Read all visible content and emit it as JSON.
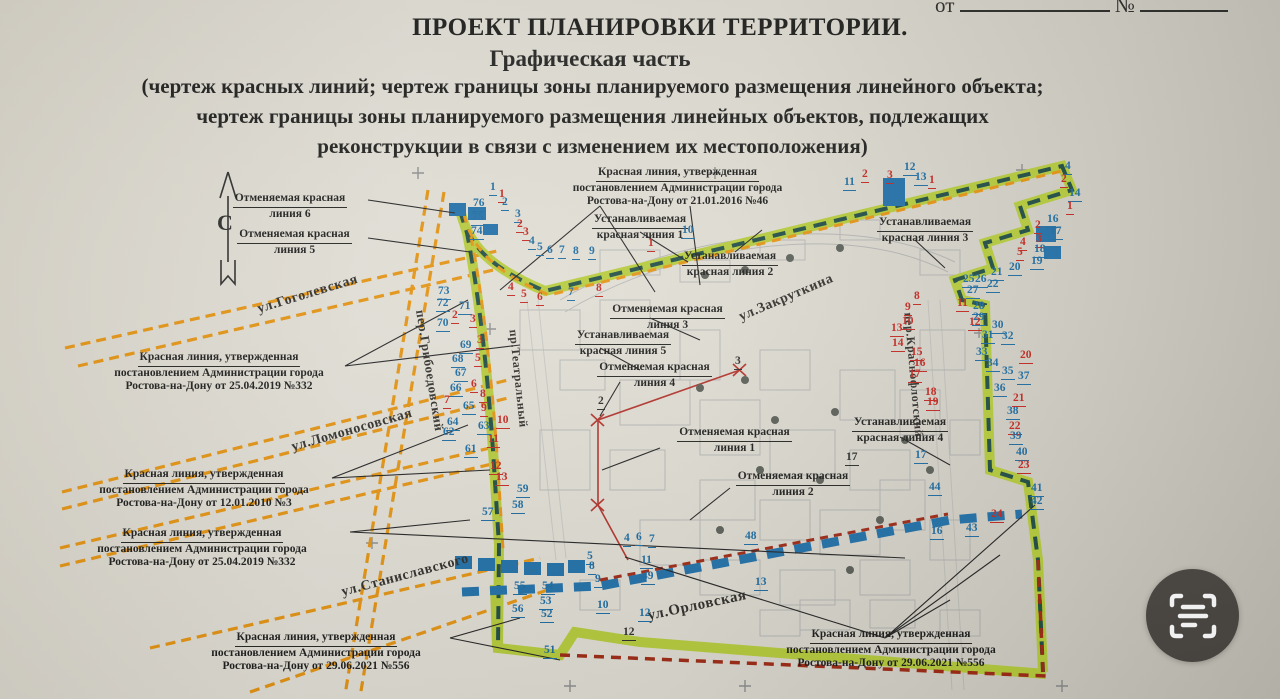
{
  "header": {
    "doc_line_prefix": "от",
    "doc_line_number_sign": "№",
    "title": "ПРОЕКТ ПЛАНИРОВКИ ТЕРРИТОРИИ.",
    "subtitle": "Графическая часть",
    "description_lines": [
      "(чертеж красных линий; чертеж границы зоны планируемого размещения линейного объекта;",
      "чертеж границы зоны планируемого размещения линейных объектов, подлежащих",
      "реконструкции в связи с изменением их местоположения)"
    ]
  },
  "compass": {
    "north_label": "С"
  },
  "colors": {
    "paper": "#ddd9cf",
    "ink": "#1d1d1b",
    "ref_blue": "#19699f",
    "ref_red": "#c1241c",
    "boundary_green": "#b4ca39",
    "boundary_teal": "#1c4a41",
    "street_orange": "#e3920f",
    "line_blue": "#1e6ea7",
    "line_dark_red": "#9c2712",
    "button_bg": "#48443f"
  },
  "callouts": [
    {
      "x": 205,
      "y": 192,
      "w": 170,
      "lines": [
        "Отменяемая красная",
        "линия 6"
      ]
    },
    {
      "x": 212,
      "y": 228,
      "w": 165,
      "lines": [
        "Отменяемая красная",
        "линия 5"
      ]
    },
    {
      "x": 545,
      "y": 166,
      "w": 265,
      "lines": [
        "Красная линия, утвержденная",
        "постановлением Администрации города",
        "Ростова-на-Дону от 21.01.2016 №46"
      ]
    },
    {
      "x": 565,
      "y": 213,
      "w": 150,
      "lines": [
        "Устанавливаемая",
        "красная линия 1"
      ]
    },
    {
      "x": 660,
      "y": 250,
      "w": 140,
      "lines": [
        "Устанавливаемая",
        "красная линия 2"
      ]
    },
    {
      "x": 855,
      "y": 216,
      "w": 140,
      "lines": [
        "Устанавливаемая",
        "красная линия 3"
      ]
    },
    {
      "x": 585,
      "y": 303,
      "w": 165,
      "lines": [
        "Отменяемая красная",
        "линия 3"
      ]
    },
    {
      "x": 548,
      "y": 329,
      "w": 150,
      "lines": [
        "Устанавливаемая",
        "красная линия 5"
      ]
    },
    {
      "x": 572,
      "y": 361,
      "w": 165,
      "lines": [
        "Отменяемая красная",
        "линия 4"
      ]
    },
    {
      "x": 652,
      "y": 426,
      "w": 165,
      "lines": [
        "Отменяемая красная",
        "линия 1"
      ]
    },
    {
      "x": 826,
      "y": 416,
      "w": 148,
      "lines": [
        "Устанавливаемая",
        "красная линия 4"
      ]
    },
    {
      "x": 712,
      "y": 470,
      "w": 162,
      "lines": [
        "Отменяемая красная",
        "линия 2"
      ]
    },
    {
      "x": 90,
      "y": 351,
      "w": 258,
      "lines": [
        "Красная линия, утвержденная",
        "постановлением Администрации города",
        "Ростова-на-Дону от 25.04.2019 №332"
      ]
    },
    {
      "x": 75,
      "y": 468,
      "w": 258,
      "lines": [
        "Красная линия, утвержденная",
        "постановлением Администрации города",
        "Ростова-на-Дону от 12.01.2010 №3"
      ]
    },
    {
      "x": 73,
      "y": 527,
      "w": 258,
      "lines": [
        "Красная линия, утвержденная",
        "постановлением Администрации города",
        "Ростова-на-Дону от 25.04.2019 №332"
      ]
    },
    {
      "x": 182,
      "y": 631,
      "w": 268,
      "lines": [
        "Красная линия, утвержденная",
        "постановлением Администрации города",
        "Ростова-на-Дону от 29.06.2021 №556"
      ]
    },
    {
      "x": 762,
      "y": 628,
      "w": 258,
      "lines": [
        "Красная линия, утвержденная",
        "постановлением Администрации города",
        "Ростова-на-Дону от 29.06.2021 №556"
      ]
    }
  ],
  "streets": [
    {
      "name": "ул.Гоголевская",
      "x": 258,
      "y": 302,
      "r": -17,
      "fs": 14
    },
    {
      "name": "пер.Грибоедовский",
      "x": 420,
      "y": 302,
      "r": 81,
      "fs": 13
    },
    {
      "name": "ул.Ломоносовская",
      "x": 292,
      "y": 440,
      "r": -16,
      "fs": 14
    },
    {
      "name": "ул.Станиславского",
      "x": 342,
      "y": 585,
      "r": -15,
      "fs": 14
    },
    {
      "name": "ул.Закруткина",
      "x": 740,
      "y": 310,
      "r": -23,
      "fs": 14
    },
    {
      "name": "ул.Орловская",
      "x": 648,
      "y": 608,
      "r": -12,
      "fs": 15
    },
    {
      "name": "пр.Театральный",
      "x": 513,
      "y": 322,
      "r": 84,
      "fs": 12
    },
    {
      "name": "пер.Краснофлотский",
      "x": 908,
      "y": 305,
      "r": 85,
      "fs": 12
    }
  ],
  "markers": [
    {
      "n": "76",
      "x": 472,
      "y": 198,
      "c": "b"
    },
    {
      "n": "75",
      "x": 471,
      "y": 212,
      "c": "b"
    },
    {
      "n": "74",
      "x": 470,
      "y": 226,
      "c": "b"
    },
    {
      "n": "73",
      "x": 437,
      "y": 286,
      "c": "b"
    },
    {
      "n": "72",
      "x": 436,
      "y": 298,
      "c": "b"
    },
    {
      "n": "71",
      "x": 458,
      "y": 301,
      "c": "b"
    },
    {
      "n": "2",
      "x": 451,
      "y": 310,
      "c": "r"
    },
    {
      "n": "3",
      "x": 469,
      "y": 314,
      "c": "r"
    },
    {
      "n": "70",
      "x": 436,
      "y": 318,
      "c": "b"
    },
    {
      "n": "69",
      "x": 459,
      "y": 340,
      "c": "b"
    },
    {
      "n": "3",
      "x": 476,
      "y": 335,
      "c": "r"
    },
    {
      "n": "68",
      "x": 451,
      "y": 354,
      "c": "b"
    },
    {
      "n": "5",
      "x": 474,
      "y": 353,
      "c": "r"
    },
    {
      "n": "67",
      "x": 454,
      "y": 368,
      "c": "b"
    },
    {
      "n": "66",
      "x": 449,
      "y": 383,
      "c": "b"
    },
    {
      "n": "6",
      "x": 470,
      "y": 379,
      "c": "r"
    },
    {
      "n": "7",
      "x": 443,
      "y": 395,
      "c": "r"
    },
    {
      "n": "65",
      "x": 462,
      "y": 401,
      "c": "b"
    },
    {
      "n": "8",
      "x": 479,
      "y": 389,
      "c": "r"
    },
    {
      "n": "64",
      "x": 446,
      "y": 417,
      "c": "b"
    },
    {
      "n": "9",
      "x": 480,
      "y": 403,
      "c": "r"
    },
    {
      "n": "63",
      "x": 477,
      "y": 421,
      "c": "b"
    },
    {
      "n": "10",
      "x": 496,
      "y": 415,
      "c": "r"
    },
    {
      "n": "62",
      "x": 442,
      "y": 427,
      "c": "b"
    },
    {
      "n": "11",
      "x": 487,
      "y": 434,
      "c": "r"
    },
    {
      "n": "61",
      "x": 464,
      "y": 444,
      "c": "b"
    },
    {
      "n": "12",
      "x": 489,
      "y": 461,
      "c": "r"
    },
    {
      "n": "13",
      "x": 495,
      "y": 472,
      "c": "r"
    },
    {
      "n": "59",
      "x": 516,
      "y": 484,
      "c": "b"
    },
    {
      "n": "58",
      "x": 511,
      "y": 500,
      "c": "b"
    },
    {
      "n": "57",
      "x": 481,
      "y": 507,
      "c": "b"
    },
    {
      "n": "1",
      "x": 489,
      "y": 182,
      "c": "b"
    },
    {
      "n": "1",
      "x": 498,
      "y": 189,
      "c": "r"
    },
    {
      "n": "2",
      "x": 501,
      "y": 197,
      "c": "b"
    },
    {
      "n": "3",
      "x": 514,
      "y": 209,
      "c": "b"
    },
    {
      "n": "2",
      "x": 516,
      "y": 219,
      "c": "r"
    },
    {
      "n": "3",
      "x": 522,
      "y": 227,
      "c": "r"
    },
    {
      "n": "4",
      "x": 528,
      "y": 236,
      "c": "b"
    },
    {
      "n": "5",
      "x": 536,
      "y": 242,
      "c": "b"
    },
    {
      "n": "6",
      "x": 546,
      "y": 245,
      "c": "b"
    },
    {
      "n": "7",
      "x": 558,
      "y": 245,
      "c": "b"
    },
    {
      "n": "8",
      "x": 572,
      "y": 246,
      "c": "b"
    },
    {
      "n": "9",
      "x": 588,
      "y": 246,
      "c": "b"
    },
    {
      "n": "4",
      "x": 507,
      "y": 282,
      "c": "r"
    },
    {
      "n": "5",
      "x": 520,
      "y": 289,
      "c": "r"
    },
    {
      "n": "6",
      "x": 536,
      "y": 292,
      "c": "r"
    },
    {
      "n": "7",
      "x": 567,
      "y": 287,
      "c": "b"
    },
    {
      "n": "8",
      "x": 595,
      "y": 283,
      "c": "r"
    },
    {
      "n": "10",
      "x": 681,
      "y": 225,
      "c": "b"
    },
    {
      "n": "1",
      "x": 647,
      "y": 238,
      "c": "r"
    },
    {
      "n": "11",
      "x": 843,
      "y": 177,
      "c": "b"
    },
    {
      "n": "2",
      "x": 861,
      "y": 169,
      "c": "r"
    },
    {
      "n": "3",
      "x": 886,
      "y": 170,
      "c": "r"
    },
    {
      "n": "12",
      "x": 903,
      "y": 162,
      "c": "b"
    },
    {
      "n": "13",
      "x": 914,
      "y": 172,
      "c": "b"
    },
    {
      "n": "1",
      "x": 928,
      "y": 175,
      "c": "r"
    },
    {
      "n": "4",
      "x": 1064,
      "y": 161,
      "c": "b"
    },
    {
      "n": "2",
      "x": 1060,
      "y": 174,
      "c": "r"
    },
    {
      "n": "14",
      "x": 1068,
      "y": 188,
      "c": "b"
    },
    {
      "n": "1",
      "x": 1066,
      "y": 201,
      "c": "r"
    },
    {
      "n": "16",
      "x": 1046,
      "y": 214,
      "c": "b"
    },
    {
      "n": "17",
      "x": 1049,
      "y": 226,
      "c": "b"
    },
    {
      "n": "2",
      "x": 1034,
      "y": 220,
      "c": "r"
    },
    {
      "n": "3",
      "x": 1035,
      "y": 234,
      "c": "r"
    },
    {
      "n": "18",
      "x": 1033,
      "y": 244,
      "c": "b"
    },
    {
      "n": "19",
      "x": 1030,
      "y": 256,
      "c": "b"
    },
    {
      "n": "4",
      "x": 1019,
      "y": 237,
      "c": "r"
    },
    {
      "n": "5",
      "x": 1016,
      "y": 247,
      "c": "r"
    },
    {
      "n": "20",
      "x": 1008,
      "y": 262,
      "c": "b"
    },
    {
      "n": "21",
      "x": 990,
      "y": 267,
      "c": "b"
    },
    {
      "n": "22",
      "x": 986,
      "y": 279,
      "c": "b"
    },
    {
      "n": "25",
      "x": 962,
      "y": 274,
      "c": "b"
    },
    {
      "n": "26",
      "x": 974,
      "y": 274,
      "c": "b"
    },
    {
      "n": "27",
      "x": 966,
      "y": 285,
      "c": "b"
    },
    {
      "n": "28",
      "x": 972,
      "y": 301,
      "c": "b"
    },
    {
      "n": "29",
      "x": 972,
      "y": 312,
      "c": "b"
    },
    {
      "n": "30",
      "x": 991,
      "y": 320,
      "c": "b"
    },
    {
      "n": "31",
      "x": 981,
      "y": 330,
      "c": "b"
    },
    {
      "n": "32",
      "x": 1001,
      "y": 331,
      "c": "b"
    },
    {
      "n": "33",
      "x": 975,
      "y": 347,
      "c": "b"
    },
    {
      "n": "34",
      "x": 986,
      "y": 358,
      "c": "b"
    },
    {
      "n": "35",
      "x": 1001,
      "y": 366,
      "c": "b"
    },
    {
      "n": "37",
      "x": 1017,
      "y": 371,
      "c": "b"
    },
    {
      "n": "36",
      "x": 993,
      "y": 383,
      "c": "b"
    },
    {
      "n": "38",
      "x": 1006,
      "y": 406,
      "c": "b"
    },
    {
      "n": "20",
      "x": 1019,
      "y": 350,
      "c": "r"
    },
    {
      "n": "21",
      "x": 1012,
      "y": 393,
      "c": "r"
    },
    {
      "n": "8",
      "x": 913,
      "y": 291,
      "c": "r"
    },
    {
      "n": "9",
      "x": 904,
      "y": 302,
      "c": "r"
    },
    {
      "n": "10",
      "x": 901,
      "y": 316,
      "c": "r"
    },
    {
      "n": "11",
      "x": 956,
      "y": 298,
      "c": "r"
    },
    {
      "n": "12",
      "x": 968,
      "y": 317,
      "c": "r"
    },
    {
      "n": "13",
      "x": 890,
      "y": 323,
      "c": "r"
    },
    {
      "n": "14",
      "x": 891,
      "y": 338,
      "c": "r"
    },
    {
      "n": "15",
      "x": 910,
      "y": 347,
      "c": "r"
    },
    {
      "n": "16",
      "x": 913,
      "y": 358,
      "c": "r"
    },
    {
      "n": "17",
      "x": 908,
      "y": 369,
      "c": "r"
    },
    {
      "n": "18",
      "x": 924,
      "y": 387,
      "c": "r"
    },
    {
      "n": "19",
      "x": 926,
      "y": 397,
      "c": "r"
    },
    {
      "n": "22",
      "x": 1008,
      "y": 421,
      "c": "r"
    },
    {
      "n": "39",
      "x": 1009,
      "y": 431,
      "c": "b"
    },
    {
      "n": "40",
      "x": 1015,
      "y": 447,
      "c": "b"
    },
    {
      "n": "23",
      "x": 1017,
      "y": 460,
      "c": "r"
    },
    {
      "n": "41",
      "x": 1030,
      "y": 483,
      "c": "b"
    },
    {
      "n": "42",
      "x": 1030,
      "y": 496,
      "c": "b"
    },
    {
      "n": "24",
      "x": 990,
      "y": 509,
      "c": "r"
    },
    {
      "n": "43",
      "x": 965,
      "y": 523,
      "c": "b"
    },
    {
      "n": "44",
      "x": 928,
      "y": 482,
      "c": "b"
    },
    {
      "n": "16",
      "x": 930,
      "y": 526,
      "c": "b"
    },
    {
      "n": "17",
      "x": 914,
      "y": 450,
      "c": "b"
    },
    {
      "n": "55",
      "x": 513,
      "y": 581,
      "c": "b"
    },
    {
      "n": "54",
      "x": 541,
      "y": 581,
      "c": "b"
    },
    {
      "n": "56",
      "x": 511,
      "y": 604,
      "c": "b"
    },
    {
      "n": "53",
      "x": 539,
      "y": 596,
      "c": "b"
    },
    {
      "n": "52",
      "x": 540,
      "y": 609,
      "c": "b"
    },
    {
      "n": "51",
      "x": 543,
      "y": 645,
      "c": "b"
    },
    {
      "n": "49",
      "x": 641,
      "y": 571,
      "c": "b"
    },
    {
      "n": "48",
      "x": 744,
      "y": 531,
      "c": "b"
    },
    {
      "n": "9",
      "x": 594,
      "y": 574,
      "c": "b"
    },
    {
      "n": "10",
      "x": 596,
      "y": 600,
      "c": "b"
    },
    {
      "n": "11",
      "x": 640,
      "y": 555,
      "c": "b"
    },
    {
      "n": "12",
      "x": 638,
      "y": 608,
      "c": "b"
    },
    {
      "n": "13",
      "x": 754,
      "y": 577,
      "c": "b"
    },
    {
      "n": "7",
      "x": 648,
      "y": 534,
      "c": "b"
    },
    {
      "n": "4",
      "x": 623,
      "y": 533,
      "c": "b"
    },
    {
      "n": "6",
      "x": 635,
      "y": 532,
      "c": "b"
    },
    {
      "n": "5",
      "x": 586,
      "y": 551,
      "c": "b"
    },
    {
      "n": "8",
      "x": 588,
      "y": 561,
      "c": "b"
    },
    {
      "n": "3",
      "x": 734,
      "y": 356,
      "c": "k"
    },
    {
      "n": "2",
      "x": 597,
      "y": 396,
      "c": "k"
    },
    {
      "n": "17",
      "x": 845,
      "y": 452,
      "c": "k"
    },
    {
      "n": "12",
      "x": 622,
      "y": 627,
      "c": "k"
    }
  ],
  "overlay": {
    "scan_button_icon": "scan-text-icon"
  }
}
